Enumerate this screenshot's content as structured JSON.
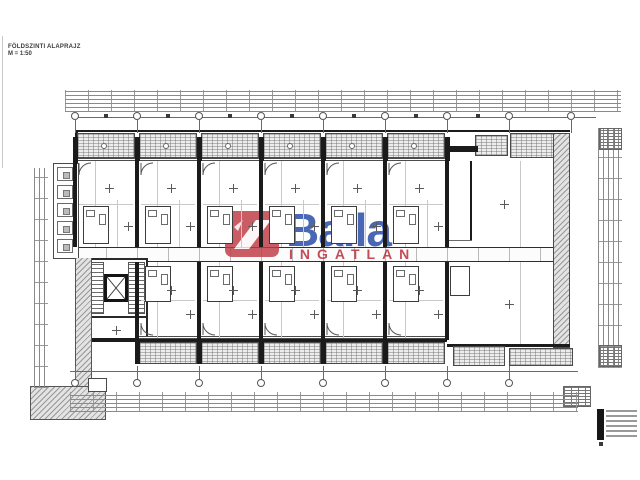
{
  "title_block": {
    "title": "FÖLDSZINTI ALAPRAJZ",
    "scale": "M = 1:50"
  },
  "watermark": {
    "brand": "Balla",
    "subtitle": "INGATLAN",
    "logo_color": "#bf3a43",
    "brand_color": "#2a4da8",
    "subtitle_color": "#bc3540"
  },
  "plan": {
    "axis_start": 75,
    "axis_step": 62,
    "bays_top": 6,
    "bays_bottom": 5,
    "axes_top": 9,
    "axes_bottom": 8,
    "storage_boxes": 5,
    "stamp_lines": 6
  }
}
